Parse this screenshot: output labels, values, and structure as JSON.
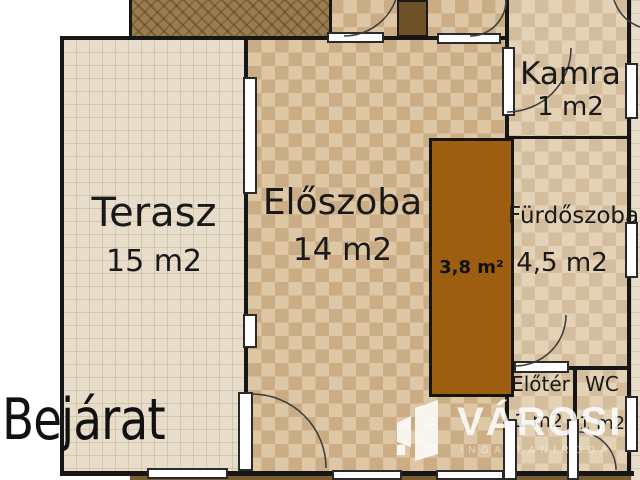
{
  "title": "Floor plan",
  "rooms": {
    "terasz": {
      "name": "Terasz",
      "area": "15 m2"
    },
    "eloszoba": {
      "name": "Előszoba",
      "area": "14 m2"
    },
    "kamra": {
      "name": "Kamra",
      "area": "1 m2"
    },
    "furdoszoba": {
      "name": "Fürdőszoba",
      "area": "4,5 m2"
    },
    "built_in": {
      "area": "3,8 m²"
    },
    "eloter": {
      "name": "Előtér",
      "area": "1 m2"
    },
    "wc": {
      "name": "WC",
      "area": "1 m2"
    }
  },
  "labels": {
    "entrance": "Bejárat"
  },
  "watermark": {
    "brand": "VÁROSI",
    "tagline": "INGATLANIRODA"
  },
  "colors": {
    "wall": "#161616",
    "terrace_floor": "#e8dcca",
    "hall_floor": "#d2b68e",
    "room_floor": "#dbc6a6",
    "dark_room": "#9e5e10",
    "wood_strip": "#9a7c4e",
    "watermark": "#ffffff"
  }
}
